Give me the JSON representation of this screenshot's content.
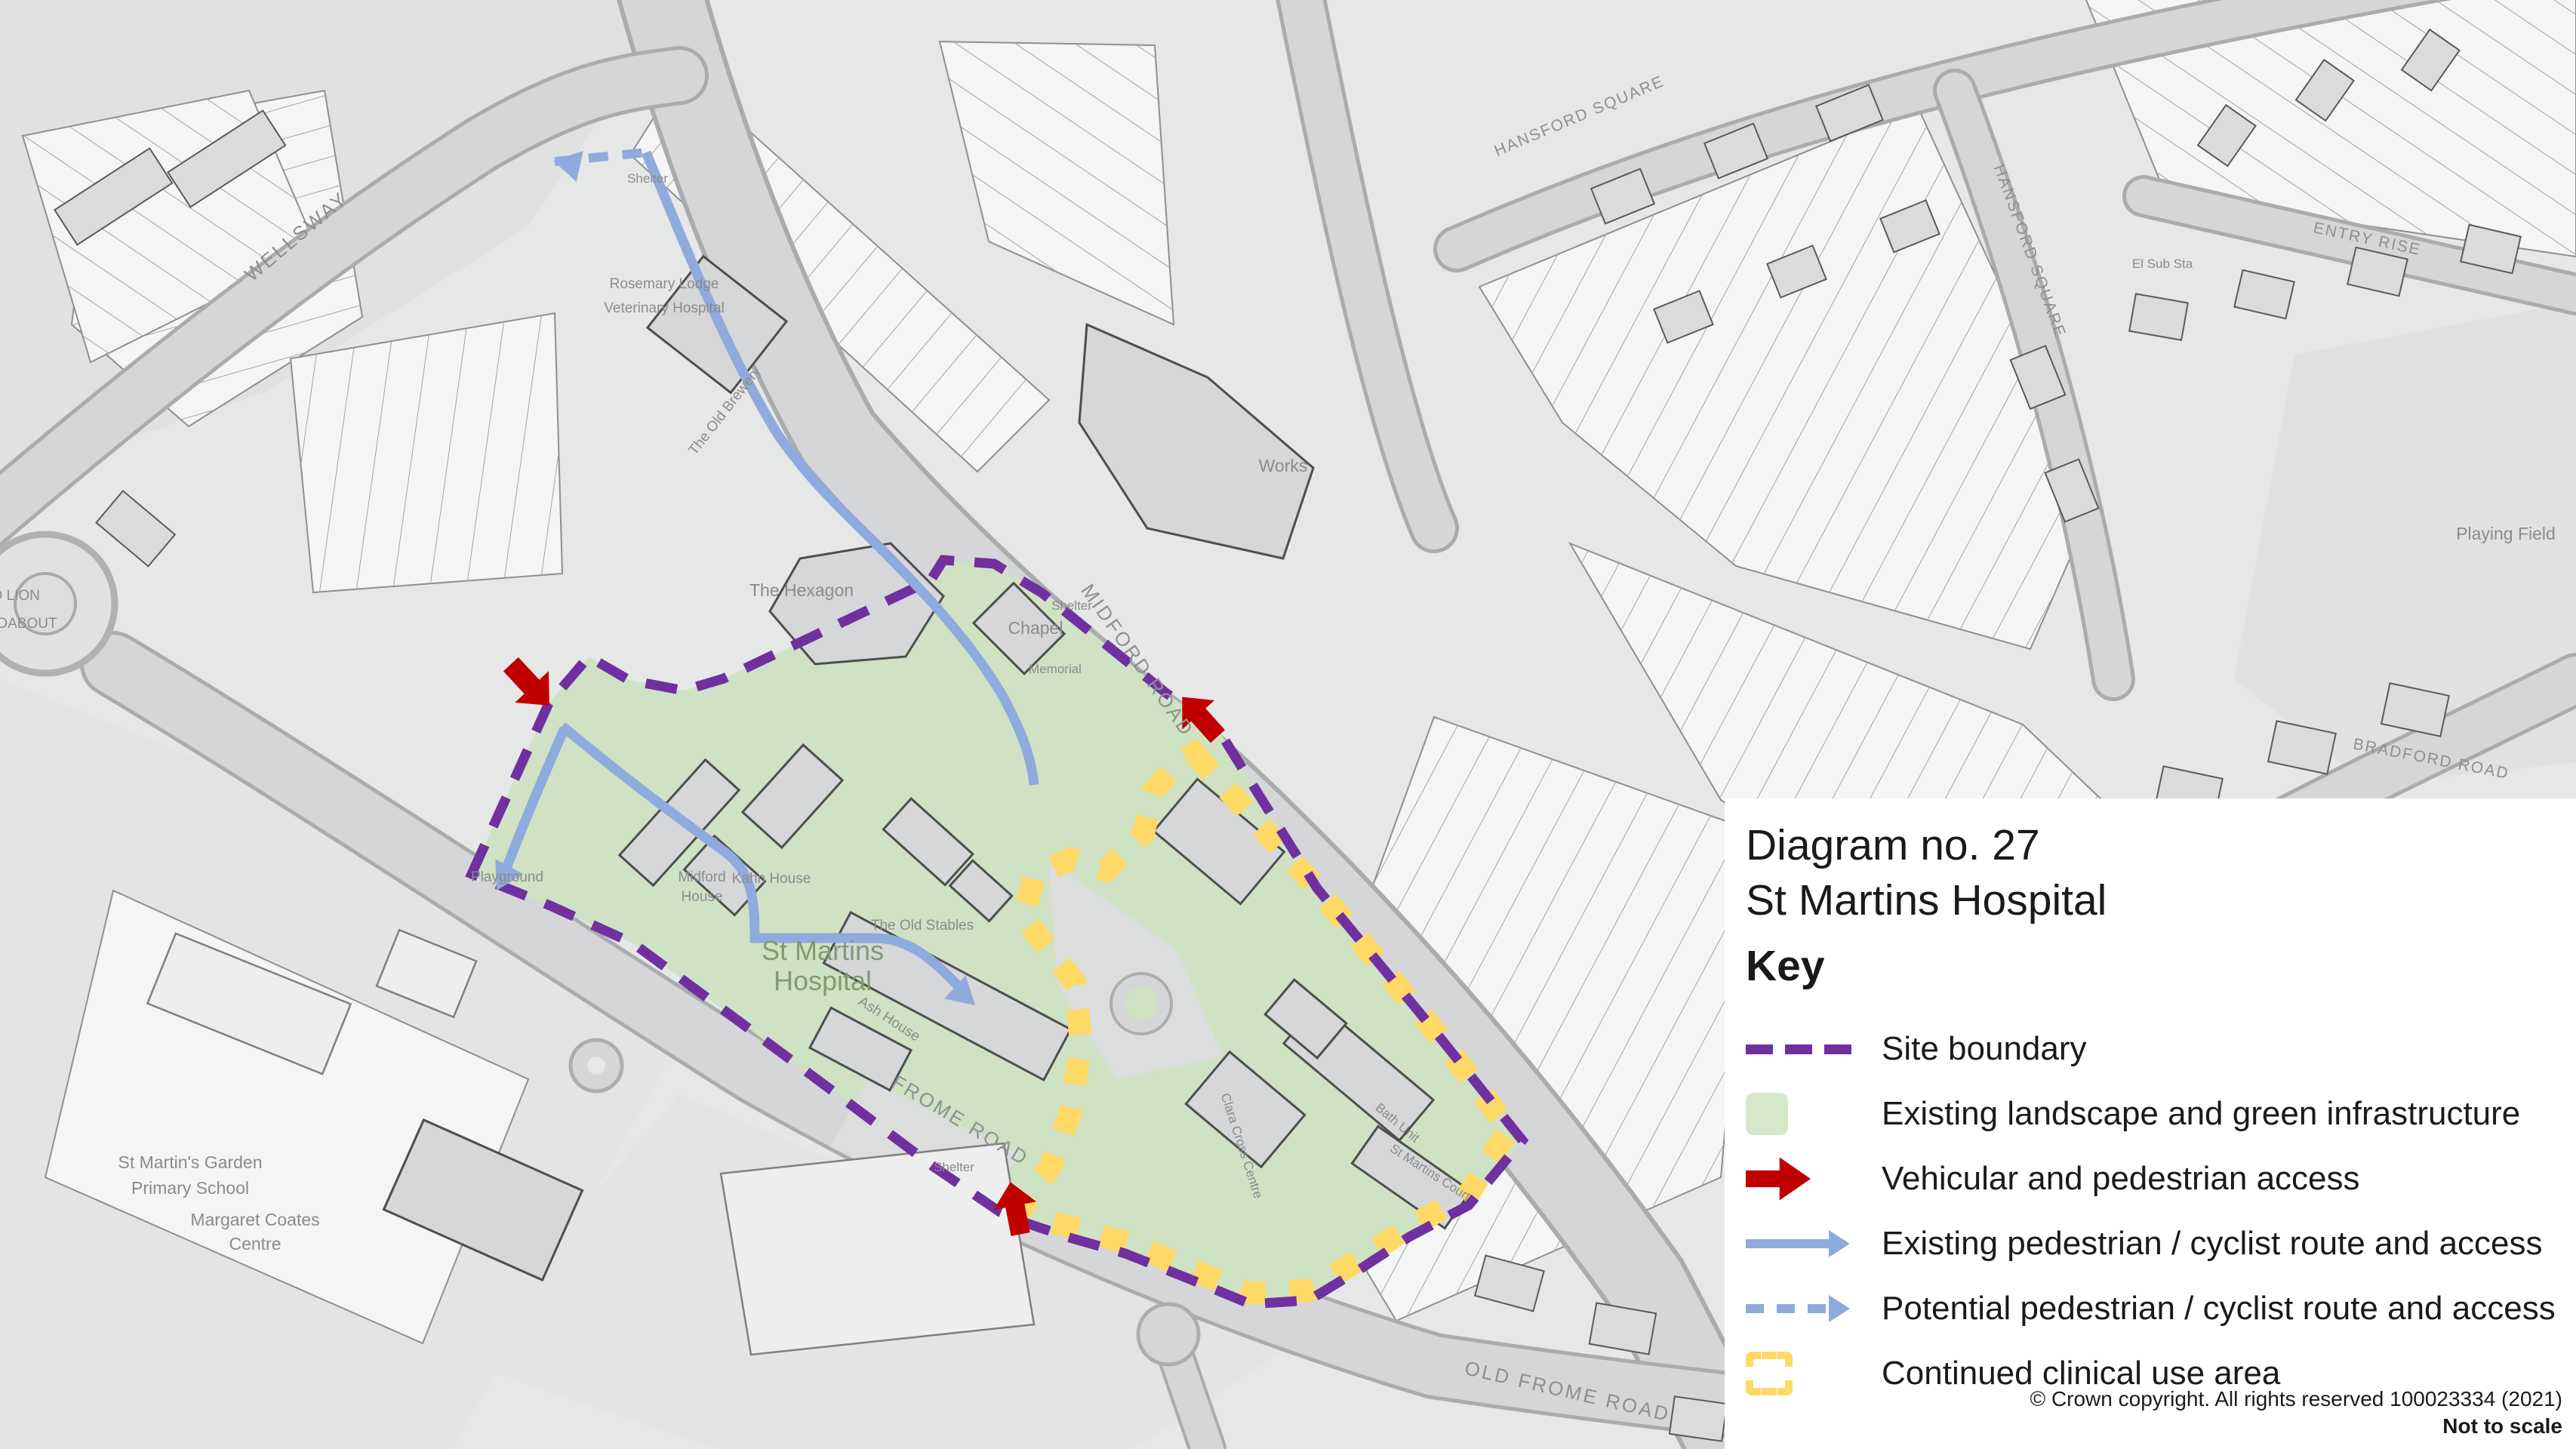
{
  "colors": {
    "purple": "#7030a0",
    "green_fill": "#d5e8ca",
    "red": "#c00000",
    "blue": "#8faadc",
    "yellow": "#ffd966",
    "map_green": "#cfe2c3",
    "hospital_text": "#7e9c70"
  },
  "legend": {
    "diagram_no": "Diagram no. 27",
    "site_name": "St Martins Hospital",
    "key_label": "Key",
    "items": [
      {
        "label": "Site boundary"
      },
      {
        "label": "Existing  landscape and green infrastructure"
      },
      {
        "label": "Vehicular and pedestrian access"
      },
      {
        "label": "Existing pedestrian / cyclist route and access"
      },
      {
        "label": "Potential pedestrian / cyclist route and access"
      },
      {
        "label": "Continued clinical use area"
      }
    ],
    "copyright": "© Crown copyright. All rights reserved 100023334 (2021)",
    "scale_note": "Not to scale"
  },
  "map_labels": {
    "roads": {
      "wellsway": "WELLSWAY",
      "midford": "MIDFORD ROAD",
      "frome": "FROME ROAD",
      "old_frome": "OLD FROME ROAD",
      "hansford1": "HANSFORD SQUARE",
      "hansford2": "HANSFORD SQUARE",
      "entry_rise": "ENTRY RISE",
      "bradford": "BRADFORD ROAD"
    },
    "places": {
      "red_lion_1": "RED LION",
      "red_lion_2": "ROUNDABOUT",
      "playing_field": "Playing Field",
      "works": "Works",
      "rosemary_1": "Rosemary Lodge",
      "rosemary_2": "Veterinary Hospital",
      "hexagon": "The Hexagon",
      "chapel": "Chapel",
      "memorial": "Memorial",
      "old_brewery": "The Old Brewery",
      "old_stables": "The Old Stables",
      "midford_house_1": "Midford",
      "midford_house_2": "House",
      "kahn_house": "Kahn House",
      "hospital_1": "St Martins",
      "hospital_2": "Hospital",
      "ash_house": "Ash House",
      "school_1": "St Martin's Garden",
      "school_2": "Primary School",
      "coates_1": "Margaret Coates",
      "coates_2": "Centre",
      "playground": "Playground",
      "shelter": "Shelter",
      "bath_unit": "Bath Unit",
      "clara_cross": "Clara Cross Centre",
      "st_martins_court": "St Martins Court",
      "el_sub_sta": "El Sub Sta"
    }
  }
}
